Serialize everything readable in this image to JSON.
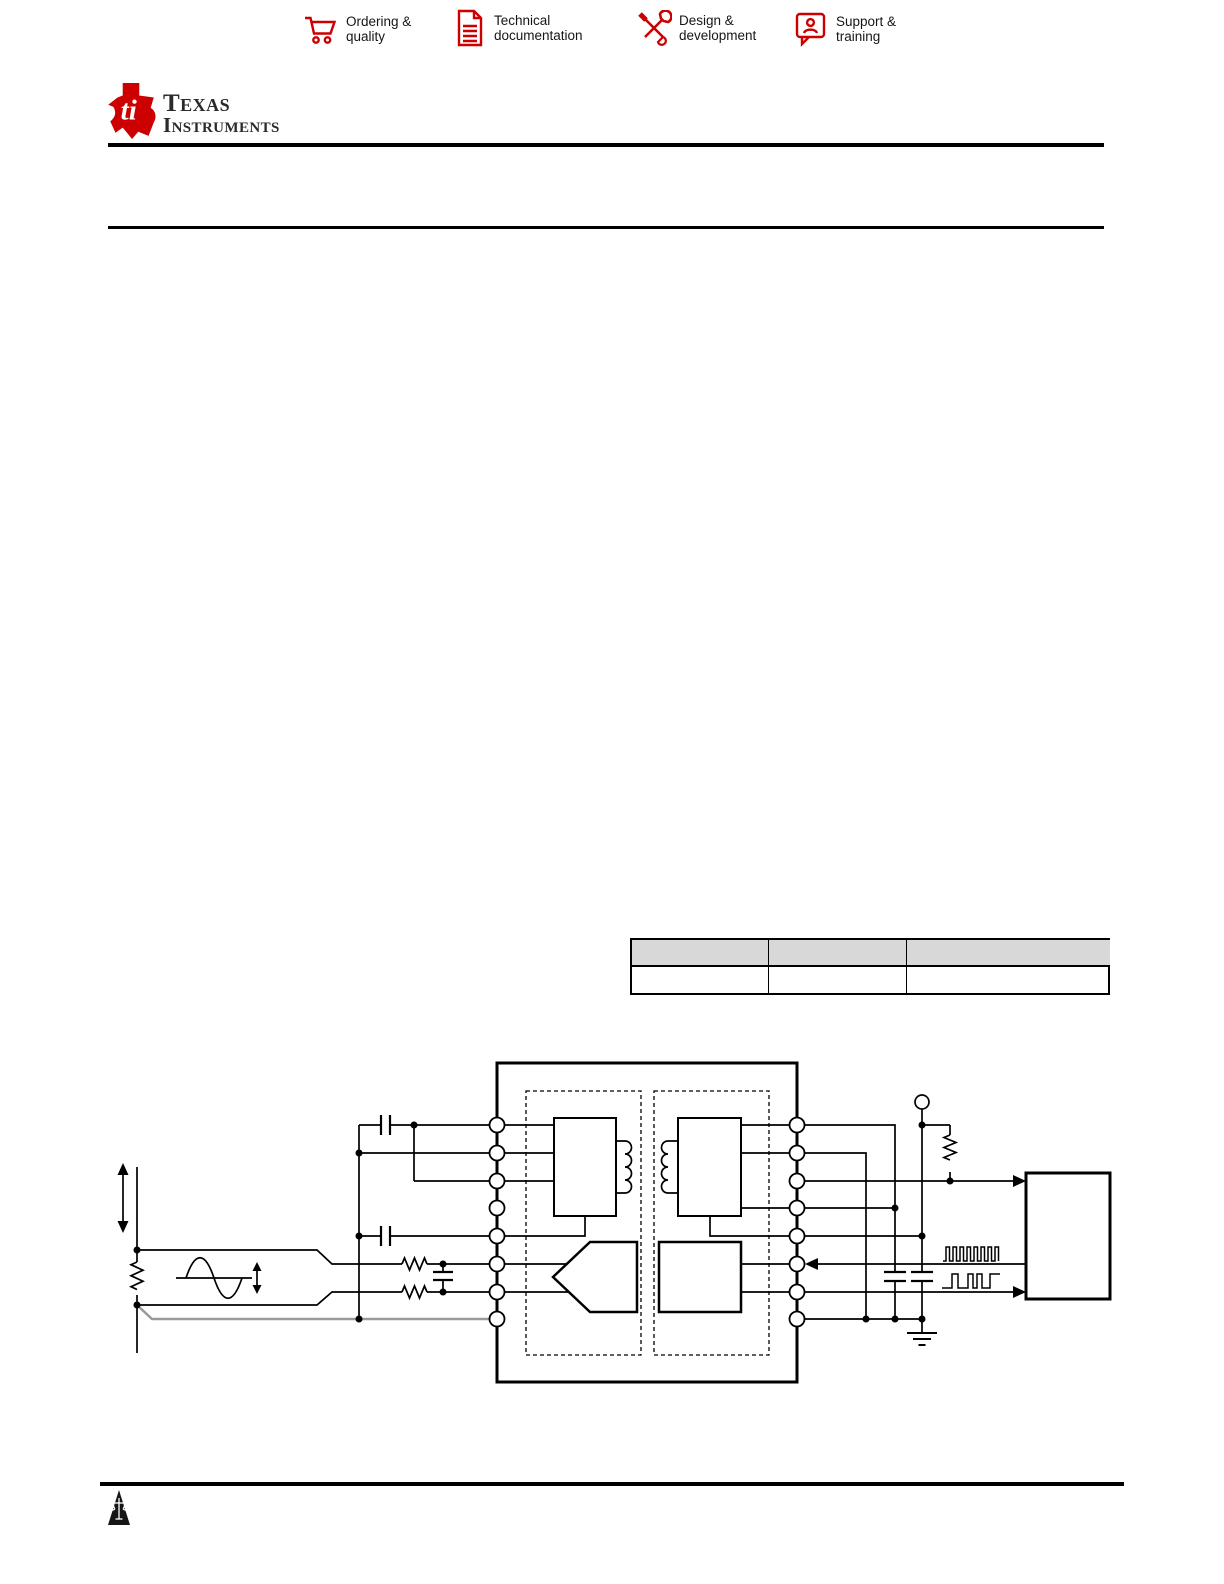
{
  "nav": {
    "accent": "#cc0000",
    "items": [
      {
        "icon": "cart-icon",
        "line1": "Ordering &",
        "line2": "quality"
      },
      {
        "icon": "document-icon",
        "line1": "Technical",
        "line2": "documentation"
      },
      {
        "icon": "tools-icon",
        "line1": "Design &",
        "line2": "development"
      },
      {
        "icon": "support-icon",
        "line1": "Support &",
        "line2": "training"
      }
    ]
  },
  "logo": {
    "brand_line1": "Texas",
    "brand_line2": "Instruments"
  },
  "device_info_table": {
    "header_bg": "#d8d8d8",
    "columns": [
      "",
      "",
      ""
    ],
    "rows": [
      [
        "",
        "",
        ""
      ]
    ]
  },
  "diagram": {
    "line_color": "#000000",
    "shield_line_color": "#9a9a9a",
    "icons": [
      "ac-source-sine-icon",
      "resistor-icon",
      "capacitor-icon",
      "transformer-coils-icon",
      "ground-icon",
      "supply-terminal-icon",
      "clock-waveform-icon",
      "data-waveform-icon"
    ]
  },
  "footer": {
    "icon": "scales-warning-icon"
  }
}
